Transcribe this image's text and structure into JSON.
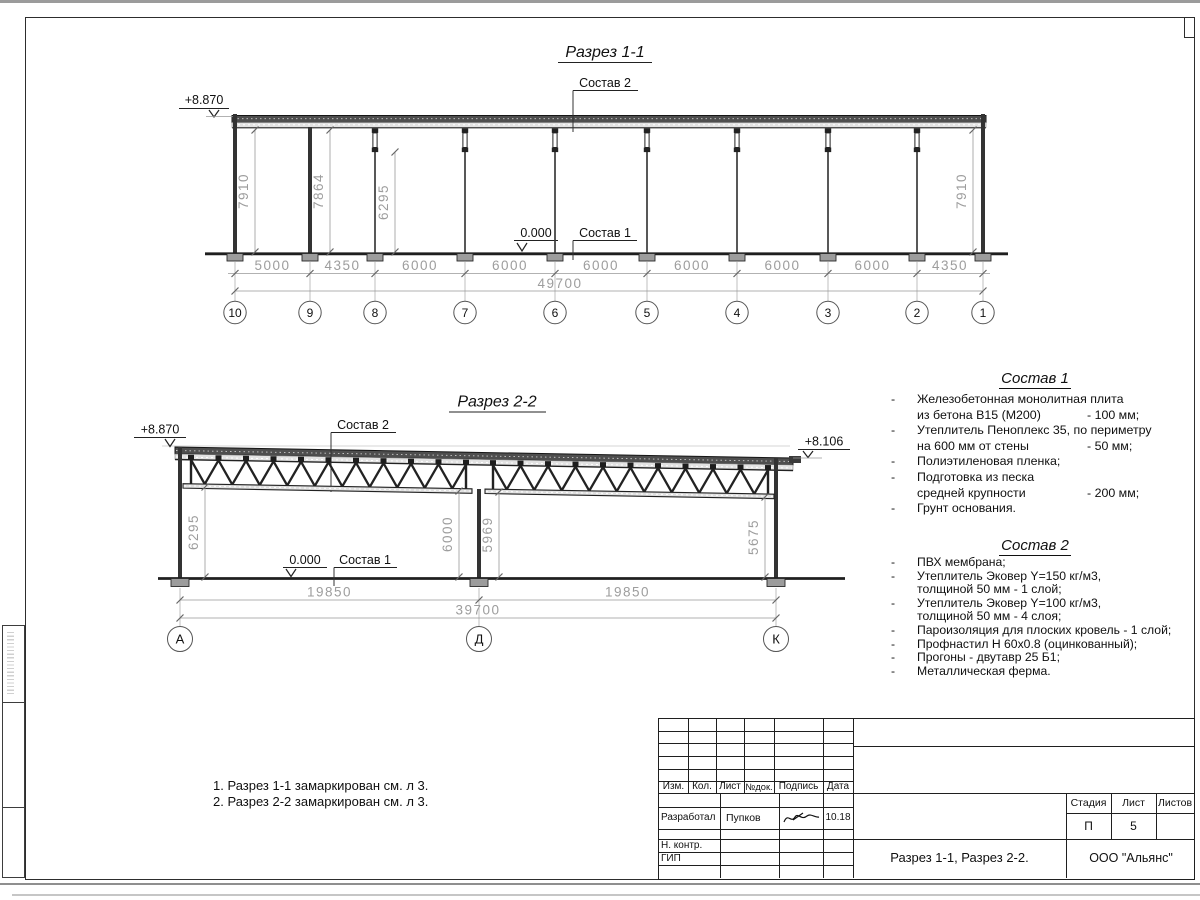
{
  "section1": {
    "title": "Разрез 1-1",
    "elevation_top": "+8.870",
    "elevation_zero": "0.000",
    "label_sostav2": "Состав 2",
    "label_sostav1": "Состав 1",
    "vertical_dims": [
      "7910",
      "7864",
      "6295",
      "7910"
    ],
    "dims": [
      "5000",
      "4350",
      "6000",
      "6000",
      "6000",
      "6000",
      "6000",
      "6000",
      "4350"
    ],
    "total": "49700",
    "axes": [
      "10",
      "9",
      "8",
      "7",
      "6",
      "5",
      "4",
      "3",
      "2",
      "1"
    ]
  },
  "section2": {
    "title": "Разрез 2-2",
    "elevation_top": "+8.870",
    "elevation_right": "+8.106",
    "elevation_zero": "0.000",
    "label_sostav2": "Состав 2",
    "label_sostav1": "Состав 1",
    "vertical_dims": [
      "6295",
      "6000",
      "5969",
      "5675"
    ],
    "dims": [
      "19850",
      "19850"
    ],
    "total": "39700",
    "axes": [
      "А",
      "Д",
      "К"
    ]
  },
  "sostav1": {
    "title": "Состав 1",
    "lines": [
      {
        "dash": "-",
        "text": "Железобетонная монолитная плита",
        "value": ""
      },
      {
        "dash": "",
        "text": "из бетона В15 (М200)",
        "value": "- 100 мм;"
      },
      {
        "dash": "-",
        "text": "Утеплитель Пеноплекс 35, по периметру",
        "value": ""
      },
      {
        "dash": "",
        "text": "на 600 мм от стены",
        "value": "- 50 мм;"
      },
      {
        "dash": "-",
        "text": "Полиэтиленовая пленка;",
        "value": ""
      },
      {
        "dash": "-",
        "text": "Подготовка из песка",
        "value": ""
      },
      {
        "dash": "",
        "text": "средней крупности",
        "value": "- 200 мм;"
      },
      {
        "dash": "-",
        "text": "Грунт основания.",
        "value": ""
      }
    ]
  },
  "sostav2": {
    "title": "Состав 2",
    "lines": [
      {
        "dash": "-",
        "text": "ПВХ мембрана;",
        "value": ""
      },
      {
        "dash": "-",
        "text": "Утеплитель Эковер Y=150 кг/м3,",
        "value": ""
      },
      {
        "dash": "",
        "text": "толщиной 50 мм - 1 слой;",
        "value": ""
      },
      {
        "dash": "-",
        "text": "Утеплитель Эковер Y=100 кг/м3,",
        "value": ""
      },
      {
        "dash": "",
        "text": "толщиной 50 мм - 4 слоя;",
        "value": ""
      },
      {
        "dash": "-",
        "text": "Пароизоляция для плоских кровель - 1 слой;",
        "value": ""
      },
      {
        "dash": "-",
        "text": "Профнастил Н 60х0.8 (оцинкованный);",
        "value": ""
      },
      {
        "dash": "-",
        "text": "Прогоны - двутавр 25 Б1;",
        "value": ""
      },
      {
        "dash": "-",
        "text": "Металлическая ферма.",
        "value": ""
      }
    ]
  },
  "notes": [
    "1. Разрез 1-1 замаркирован см. л 3.",
    "2. Разрез 2-2 замаркирован см. л 3."
  ],
  "titleblock": {
    "header": [
      "Изм.",
      "Кол.",
      "Лист",
      "№док.",
      "Подпись",
      "Дата"
    ],
    "developer_label": "Разработал",
    "developer_name": "Пупков",
    "developer_date": "10.18",
    "ncontr_label": "Н. контр.",
    "gip_label": "ГИП",
    "stage_label": "Стадия",
    "sheet_label": "Лист",
    "sheets_label": "Листов",
    "stage": "П",
    "sheet": "5",
    "sheets": "",
    "doc_title": "Разрез 1-1, Разрез 2-2.",
    "company": "ООО \"Альянс\""
  }
}
